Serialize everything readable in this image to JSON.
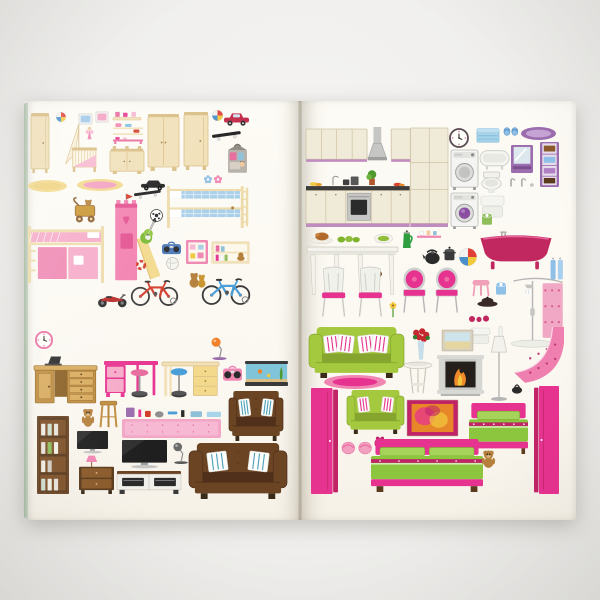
{
  "scene": {
    "description": "Photograph of an open dollhouse sticker book: left page children's room furniture stickers, right page kitchen, bathroom, living room and bedroom furniture stickers",
    "background_color": "#f0efed",
    "page_color": "#fcfaf4",
    "cover_edge_color": "#b5c7b1",
    "gutter_shadow_color": "#5a4e37"
  },
  "palette": {
    "cream": "#f1e0b8",
    "creamD": "#d9bd82",
    "creamL": "#f8efd7",
    "pink": "#f283b0",
    "pinkL": "#f7b8d0",
    "pinkD": "#e86a9e",
    "magenta": "#e73390",
    "magentaD": "#c02467",
    "blue": "#84bfe4",
    "blueL": "#c3ddf0",
    "blueD": "#4a90c8",
    "green": "#9cc23c",
    "greenD": "#7da32b",
    "purple": "#9b6cae",
    "purpleL": "#c5a3d4",
    "purpleD": "#7b4f8e",
    "brown": "#6b4423",
    "brownD": "#50301a",
    "wood": "#c08d3f",
    "woodD": "#9a6c2a",
    "woodL": "#d9ab5d",
    "silver": "#c6c6c4",
    "gray": "#8f8f8f",
    "dark": "#333333",
    "red": "#d43c2a",
    "orange": "#f0832a",
    "yellow": "#f2c93c",
    "white": "#ffffff"
  },
  "stickers": [
    {
      "n": "wardrobe-tall-cream",
      "t": "ward",
      "x": 31,
      "y": 113,
      "w": 18,
      "h": 60
    },
    {
      "n": "toy-ball-blue",
      "t": "beach",
      "x": 56,
      "y": 112,
      "w": 10,
      "h": 10
    },
    {
      "n": "picture-frame-blue",
      "t": "frameS",
      "x": 79,
      "y": 114,
      "w": 13,
      "h": 10,
      "c": {
        "col": "#9fc8e8"
      }
    },
    {
      "n": "picture-frame-pink",
      "t": "frameS",
      "x": 96,
      "y": 112,
      "w": 12,
      "h": 10,
      "c": {
        "col": "#f2a0c0"
      }
    },
    {
      "n": "shelf-pink-toys",
      "t": "shelfT",
      "x": 113,
      "y": 111,
      "w": 28,
      "h": 9
    },
    {
      "n": "crib-with-canopy",
      "t": "crib",
      "x": 63,
      "y": 124,
      "w": 35,
      "h": 50
    },
    {
      "n": "hanging-doll",
      "t": "fairy",
      "x": 85,
      "y": 126,
      "w": 9,
      "h": 14
    },
    {
      "n": "wall-shelf-toy-cars",
      "t": "shelfCars",
      "x": 113,
      "y": 122,
      "w": 30,
      "h": 13
    },
    {
      "n": "shelf-pink-rack",
      "t": "rack",
      "x": 113,
      "y": 137,
      "w": 30,
      "h": 7
    },
    {
      "n": "changing-table",
      "t": "chT",
      "x": 110,
      "y": 146,
      "w": 34,
      "h": 28
    },
    {
      "n": "wardrobe-double-cream",
      "t": "ward",
      "x": 148,
      "y": 114,
      "w": 31,
      "h": 57,
      "c": {
        "doors": 2
      }
    },
    {
      "n": "wardrobe-wide-cream",
      "t": "ward",
      "x": 184,
      "y": 112,
      "w": 24,
      "h": 58
    },
    {
      "n": "beach-ball-small",
      "t": "beach",
      "x": 212,
      "y": 110,
      "w": 11,
      "h": 11
    },
    {
      "n": "toy-car-red",
      "t": "toycar",
      "x": 224,
      "y": 112,
      "w": 25,
      "h": 14
    },
    {
      "n": "skateboard",
      "t": "skate",
      "x": 212,
      "y": 129,
      "w": 29,
      "h": 13
    },
    {
      "n": "doll-carry-house",
      "t": "dollbag",
      "x": 227,
      "y": 144,
      "w": 21,
      "h": 30
    },
    {
      "n": "rug-oval-yellow",
      "t": "rugO",
      "x": 28,
      "y": 180,
      "w": 39,
      "h": 12,
      "c": {
        "o": "#f3d98c",
        "i": "#efd27e"
      }
    },
    {
      "n": "rug-oval-pink-yellow",
      "t": "rugO",
      "x": 77,
      "y": 179,
      "w": 46,
      "h": 12,
      "c": {
        "o": "#f3d98c",
        "i": "#f2a0c0"
      }
    },
    {
      "n": "toy-car-black",
      "t": "carB",
      "x": 141,
      "y": 180,
      "w": 24,
      "h": 11
    },
    {
      "n": "flower-stickers",
      "t": "flower2",
      "x": 203,
      "y": 175,
      "w": 20,
      "h": 9
    },
    {
      "n": "bunk-bed-blue",
      "t": "bunk",
      "x": 167,
      "y": 186,
      "w": 82,
      "h": 42
    },
    {
      "n": "dresser-pink",
      "t": "cab",
      "x": 28,
      "y": 194,
      "w": 41,
      "h": 29
    },
    {
      "n": "baby-walker-teddy",
      "t": "walker",
      "x": 71,
      "y": 196,
      "w": 28,
      "h": 27
    },
    {
      "n": "skateboard-2",
      "t": "skate",
      "x": 134,
      "y": 188,
      "w": 27,
      "h": 12
    },
    {
      "n": "play-tower-castle",
      "t": "castle",
      "x": 109,
      "y": 192,
      "w": 52,
      "h": 90
    },
    {
      "n": "football",
      "t": "foot",
      "x": 150,
      "y": 209,
      "w": 13,
      "h": 13
    },
    {
      "n": "electric-guitar",
      "t": "guitar",
      "x": 139,
      "y": 219,
      "w": 20,
      "h": 27
    },
    {
      "n": "loft-bed-pink",
      "t": "loft",
      "x": 28,
      "y": 226,
      "w": 76,
      "h": 57
    },
    {
      "n": "boombox-blue",
      "t": "boombox",
      "x": 162,
      "y": 242,
      "w": 19,
      "h": 14,
      "c": {
        "col": "#4a78b8"
      }
    },
    {
      "n": "noticeboard-pink",
      "t": "notice",
      "x": 186,
      "y": 240,
      "w": 22,
      "h": 24
    },
    {
      "n": "wall-shelf-books",
      "t": "wallShelfB",
      "x": 212,
      "y": 242,
      "w": 37,
      "h": 21
    },
    {
      "n": "volleyball",
      "t": "volley",
      "x": 166,
      "y": 257,
      "w": 13,
      "h": 13
    },
    {
      "n": "red-ring",
      "t": "ring",
      "x": 136,
      "y": 260,
      "w": 10,
      "h": 10
    },
    {
      "n": "teddy-bears-pair",
      "t": "teddy2",
      "x": 187,
      "y": 271,
      "w": 21,
      "h": 17
    },
    {
      "n": "bicycle-red",
      "t": "bike",
      "x": 131,
      "y": 274,
      "w": 47,
      "h": 32,
      "c": {
        "col": "#d43c2a"
      }
    },
    {
      "n": "bicycle-blue",
      "t": "bike",
      "x": 202,
      "y": 272,
      "w": 48,
      "h": 33,
      "c": {
        "col": "#4a9fd8"
      }
    },
    {
      "n": "motorbike-red",
      "t": "moto",
      "x": 97,
      "y": 290,
      "w": 30,
      "h": 18
    },
    {
      "n": "wall-clock-pink",
      "t": "clockW",
      "x": 35,
      "y": 331,
      "w": 18,
      "h": 18,
      "c": {
        "rim": "#e86a9e"
      }
    },
    {
      "n": "cabinet-light-blue",
      "t": "cab",
      "x": 61,
      "y": 330,
      "w": 42,
      "h": 28,
      "c": {
        "fr": "#a8cfe4",
        "pa": "#eef7fb"
      }
    },
    {
      "n": "desk-lamp-orange",
      "t": "lampD",
      "x": 210,
      "y": 336,
      "w": 19,
      "h": 24,
      "c": {
        "col": "#f0832a",
        "base": "#9b6cae"
      }
    },
    {
      "n": "desk-wooden",
      "t": "deskW",
      "x": 34,
      "y": 356,
      "w": 63,
      "h": 51
    },
    {
      "n": "desk-pink",
      "t": "deskP",
      "x": 104,
      "y": 361,
      "w": 54,
      "h": 36
    },
    {
      "n": "bar-stool-pink",
      "t": "barst",
      "x": 130,
      "y": 369,
      "w": 19,
      "h": 29,
      "c": {
        "col": "#e86a9e"
      }
    },
    {
      "n": "desk-cream",
      "t": "deskC",
      "x": 162,
      "y": 362,
      "w": 57,
      "h": 36
    },
    {
      "n": "bar-stool-blue",
      "t": "barst",
      "x": 170,
      "y": 368,
      "w": 18,
      "h": 30,
      "c": {
        "col": "#4a9fd8"
      }
    },
    {
      "n": "boombox-pink",
      "t": "boombox",
      "x": 223,
      "y": 366,
      "w": 19,
      "h": 17,
      "c": {
        "col": "#ef87b2"
      }
    },
    {
      "n": "aquarium",
      "t": "aqua",
      "x": 245,
      "y": 361,
      "w": 43,
      "h": 25
    },
    {
      "n": "armchair-brown",
      "t": "seat",
      "x": 229,
      "y": 391,
      "w": 54,
      "h": 50,
      "c": {
        "body": "#6b4423",
        "dark": "#50301a",
        "pil": "#4a9fb8",
        "pn": 2,
        "tuft": 1
      }
    },
    {
      "n": "teddy-bear-small",
      "t": "teddy",
      "x": 81,
      "y": 408,
      "w": 14,
      "h": 19
    },
    {
      "n": "stool-wooden",
      "t": "stoolW",
      "x": 99,
      "y": 400,
      "w": 19,
      "h": 28
    },
    {
      "n": "cosmetics-set",
      "t": "cosm",
      "x": 126,
      "y": 405,
      "w": 95,
      "h": 13
    },
    {
      "n": "rug-pink",
      "t": "rugR",
      "x": 122,
      "y": 419,
      "w": 99,
      "h": 19
    },
    {
      "n": "bookshelf-brown",
      "t": "shelfBk",
      "x": 37,
      "y": 416,
      "w": 32,
      "h": 78
    },
    {
      "n": "tv-small",
      "t": "tv",
      "x": 77,
      "y": 431,
      "w": 31,
      "h": 23
    },
    {
      "n": "nightstand-with-lamp",
      "t": "nstL",
      "x": 79,
      "y": 455,
      "w": 35,
      "h": 39
    },
    {
      "n": "tv-large",
      "t": "tv",
      "x": 122,
      "y": 440,
      "w": 45,
      "h": 29
    },
    {
      "n": "desk-lamp-gray",
      "t": "lampD",
      "x": 172,
      "y": 441,
      "w": 18,
      "h": 23,
      "c": {
        "col": "#6b6b6b",
        "base": "#555555"
      }
    },
    {
      "n": "tv-stand",
      "t": "tvSt",
      "x": 117,
      "y": 471,
      "w": 64,
      "h": 23
    },
    {
      "n": "sofa-brown",
      "t": "seat",
      "x": 189,
      "y": 443,
      "w": 98,
      "h": 56,
      "c": {
        "body": "#6b4423",
        "dark": "#50301a",
        "pil": "#4a9fb8",
        "pn": 2,
        "tuft": 1,
        "sofa": 1
      }
    },
    {
      "n": "kitchen-set",
      "t": "kitchen",
      "x": 306,
      "y": 127,
      "w": 142,
      "h": 101
    },
    {
      "n": "wall-clock",
      "t": "clockW",
      "x": 449,
      "y": 128,
      "w": 20,
      "h": 20,
      "c": {
        "rim": "#5a4a52"
      }
    },
    {
      "n": "storage-box-blue",
      "t": "boxC",
      "x": 477,
      "y": 127,
      "w": 22,
      "h": 16
    },
    {
      "n": "slippers-blue",
      "t": "slip",
      "x": 504,
      "y": 127,
      "w": 14,
      "h": 9,
      "c": {
        "col": "#8fc0e8",
        "band": "#5a94c8"
      }
    },
    {
      "n": "bath-rug-purple",
      "t": "rugO",
      "x": 521,
      "y": 127,
      "w": 35,
      "h": 13,
      "c": {
        "o": "#9b6cae",
        "i": "#c5a3d4"
      }
    },
    {
      "n": "washing-machine",
      "t": "washer",
      "x": 451,
      "y": 150,
      "w": 27,
      "h": 40
    },
    {
      "n": "bathtub-white",
      "t": "tubW",
      "x": 480,
      "y": 149,
      "w": 29,
      "h": 21
    },
    {
      "n": "mirror-cabinet-purple",
      "t": "mirCab",
      "x": 511,
      "y": 145,
      "w": 22,
      "h": 28
    },
    {
      "n": "bathroom-cabinet-tall",
      "t": "tallP",
      "x": 540,
      "y": 142,
      "w": 19,
      "h": 45
    },
    {
      "n": "toilet-white",
      "t": "toiletW",
      "x": 480,
      "y": 172,
      "w": 23,
      "h": 21
    },
    {
      "n": "faucet-set",
      "t": "faucets",
      "x": 507,
      "y": 177,
      "w": 27,
      "h": 10
    },
    {
      "n": "vanity-purple",
      "t": "cab",
      "x": 506,
      "y": 189,
      "w": 28,
      "h": 30,
      "c": {
        "fr": "#9b6cae",
        "pa": "#c5a3d4",
        "noTop": 1
      }
    },
    {
      "n": "washing-machine-2",
      "t": "washer",
      "x": 451,
      "y": 193,
      "w": 27,
      "h": 36,
      "c": {
        "purple": 1
      }
    },
    {
      "n": "towels-folded",
      "t": "towelW",
      "x": 481,
      "y": 196,
      "w": 23,
      "h": 22
    },
    {
      "n": "toilet-paper-green",
      "t": "paper",
      "x": 482,
      "y": 213,
      "w": 10,
      "h": 13,
      "c": {
        "col": "#8fbe5a"
      }
    },
    {
      "n": "bathroom-cabinet-small",
      "t": "cab",
      "x": 540,
      "y": 191,
      "w": 19,
      "h": 30,
      "c": {
        "fr": "#9b6cae",
        "pa": "#b790c7",
        "noTop": 1,
        "one": 1
      }
    },
    {
      "n": "roast-platter",
      "t": "foodT",
      "x": 311,
      "y": 231,
      "w": 22,
      "h": 13
    },
    {
      "n": "cucumbers",
      "t": "foodG",
      "x": 337,
      "y": 235,
      "w": 24,
      "h": 9
    },
    {
      "n": "salad-plate",
      "t": "foodP",
      "x": 374,
      "y": 233,
      "w": 19,
      "h": 11
    },
    {
      "n": "jug-green",
      "t": "jug",
      "x": 401,
      "y": 230,
      "w": 13,
      "h": 19
    },
    {
      "n": "shelf-pink-cups",
      "t": "shelfCups",
      "x": 417,
      "y": 230,
      "w": 24,
      "h": 9
    },
    {
      "n": "kettle-black",
      "t": "kettle",
      "x": 422,
      "y": 247,
      "w": 20,
      "h": 18
    },
    {
      "n": "pot-black",
      "t": "pot",
      "x": 443,
      "y": 245,
      "w": 13,
      "h": 17
    },
    {
      "n": "beach-ball-large",
      "t": "beach",
      "x": 459,
      "y": 248,
      "w": 18,
      "h": 18
    },
    {
      "n": "bathtub-pink-clawfoot",
      "t": "tubP",
      "x": 479,
      "y": 231,
      "w": 74,
      "h": 40
    },
    {
      "n": "towels-hanging-blue",
      "t": "towelsB",
      "x": 550,
      "y": 257,
      "w": 14,
      "h": 24
    },
    {
      "n": "dining-table-white",
      "t": "tableD",
      "x": 307,
      "y": 247,
      "w": 91,
      "h": 49
    },
    {
      "n": "coffee-cups",
      "t": "cupsSm",
      "x": 369,
      "y": 270,
      "w": 14,
      "h": 8
    },
    {
      "n": "dining-chairs-white",
      "t": "chairsW",
      "x": 318,
      "y": 267,
      "w": 68,
      "h": 51
    },
    {
      "n": "baroque-chairs-pink",
      "t": "chairsB",
      "x": 402,
      "y": 267,
      "w": 59,
      "h": 47
    },
    {
      "n": "stool-pink",
      "t": "stoolP",
      "x": 471,
      "y": 280,
      "w": 20,
      "h": 17
    },
    {
      "n": "toilet-paper-blue",
      "t": "paper",
      "x": 496,
      "y": 282,
      "w": 10,
      "h": 14,
      "c": {
        "col": "#8fc0e8"
      }
    },
    {
      "n": "beret-black",
      "t": "hat",
      "x": 477,
      "y": 296,
      "w": 21,
      "h": 11
    },
    {
      "n": "shower-set",
      "t": "shower",
      "x": 509,
      "y": 276,
      "w": 56,
      "h": 72
    },
    {
      "n": "flower-yellow",
      "t": "flowerY",
      "x": 388,
      "y": 302,
      "w": 10,
      "h": 16
    },
    {
      "n": "berries-red",
      "t": "dots3",
      "x": 469,
      "y": 315,
      "w": 20,
      "h": 8
    },
    {
      "n": "towel-stack",
      "t": "towelW",
      "x": 471,
      "y": 328,
      "w": 19,
      "h": 16
    },
    {
      "n": "toilet-brush",
      "t": "brush",
      "x": 496,
      "y": 325,
      "w": 9,
      "h": 20
    },
    {
      "n": "sofa-green",
      "t": "seat",
      "x": 309,
      "y": 327,
      "w": 95,
      "h": 51,
      "c": {
        "body": "#a5c93e",
        "dark": "#85a52e",
        "pil": "#e73390",
        "pn": 4,
        "sofa": 1
      }
    },
    {
      "n": "rug-oval-pink",
      "t": "rugO",
      "x": 324,
      "y": 375,
      "w": 62,
      "h": 14,
      "c": {
        "o": "#ef87b2",
        "i": "#e73390"
      }
    },
    {
      "n": "vase-with-roses",
      "t": "vaseF",
      "x": 409,
      "y": 327,
      "w": 24,
      "h": 34
    },
    {
      "n": "side-table-round",
      "t": "sideT",
      "x": 404,
      "y": 362,
      "w": 28,
      "h": 33
    },
    {
      "n": "picture-beach",
      "t": "picture",
      "x": 442,
      "y": 330,
      "w": 31,
      "h": 21,
      "c": {
        "fr": "#d8cfbc",
        "bg": "#cfe3ea",
        "sand": 1
      }
    },
    {
      "n": "fireplace",
      "t": "fire",
      "x": 437,
      "y": 353,
      "w": 47,
      "h": 43
    },
    {
      "n": "floor-lamp",
      "t": "lampF",
      "x": 489,
      "y": 335,
      "w": 20,
      "h": 66
    },
    {
      "n": "staircase-pink",
      "t": "stair",
      "x": 512,
      "y": 327,
      "w": 52,
      "h": 57
    },
    {
      "n": "handbag-black",
      "t": "bag",
      "x": 511,
      "y": 384,
      "w": 12,
      "h": 10
    },
    {
      "n": "armchair-green",
      "t": "seat",
      "x": 347,
      "y": 390,
      "w": 57,
      "h": 44,
      "c": {
        "body": "#a5c93e",
        "dark": "#85a52e",
        "pil": "#e73390",
        "pn": 2
      }
    },
    {
      "n": "picture-abstract",
      "t": "picture",
      "x": 407,
      "y": 400,
      "w": 51,
      "h": 36,
      "c": {
        "fr": "#c02467",
        "bg": "#e8872a",
        "blob": 1
      }
    },
    {
      "n": "wardrobe-pink-left",
      "t": "wardP",
      "x": 311,
      "y": 388,
      "w": 27,
      "h": 106
    },
    {
      "n": "bed-single-pink",
      "t": "bed",
      "x": 469,
      "y": 403,
      "w": 59,
      "h": 51,
      "c": {
        "single": 1
      }
    },
    {
      "n": "wardrobe-pink-right",
      "t": "wardP",
      "x": 534,
      "y": 386,
      "w": 25,
      "h": 108,
      "c": {
        "flip": 1
      }
    },
    {
      "n": "slippers-pink",
      "t": "slip",
      "x": 342,
      "y": 441,
      "w": 30,
      "h": 14,
      "c": {
        "col": "#f2a0c0",
        "band": "#e86a9e"
      }
    },
    {
      "n": "alarm-clock",
      "t": "alarm",
      "x": 374,
      "y": 436,
      "w": 12,
      "h": 13
    },
    {
      "n": "nightstand-pink-left",
      "t": "cab",
      "x": 342,
      "y": 462,
      "w": 24,
      "h": 32,
      "c": {
        "fr": "#e86a9e",
        "pa": "#f7b8d0",
        "one": 1
      }
    },
    {
      "n": "bed-double-pink",
      "t": "bed",
      "x": 371,
      "y": 439,
      "w": 112,
      "h": 53
    },
    {
      "n": "teddy-bear",
      "t": "teddy",
      "x": 481,
      "y": 450,
      "w": 15,
      "h": 18
    },
    {
      "n": "nightstand-pink-right",
      "t": "cab",
      "x": 499,
      "y": 460,
      "w": 24,
      "h": 33,
      "c": {
        "fr": "#e86a9e",
        "pa": "#f7b8d0",
        "one": 1
      }
    }
  ]
}
